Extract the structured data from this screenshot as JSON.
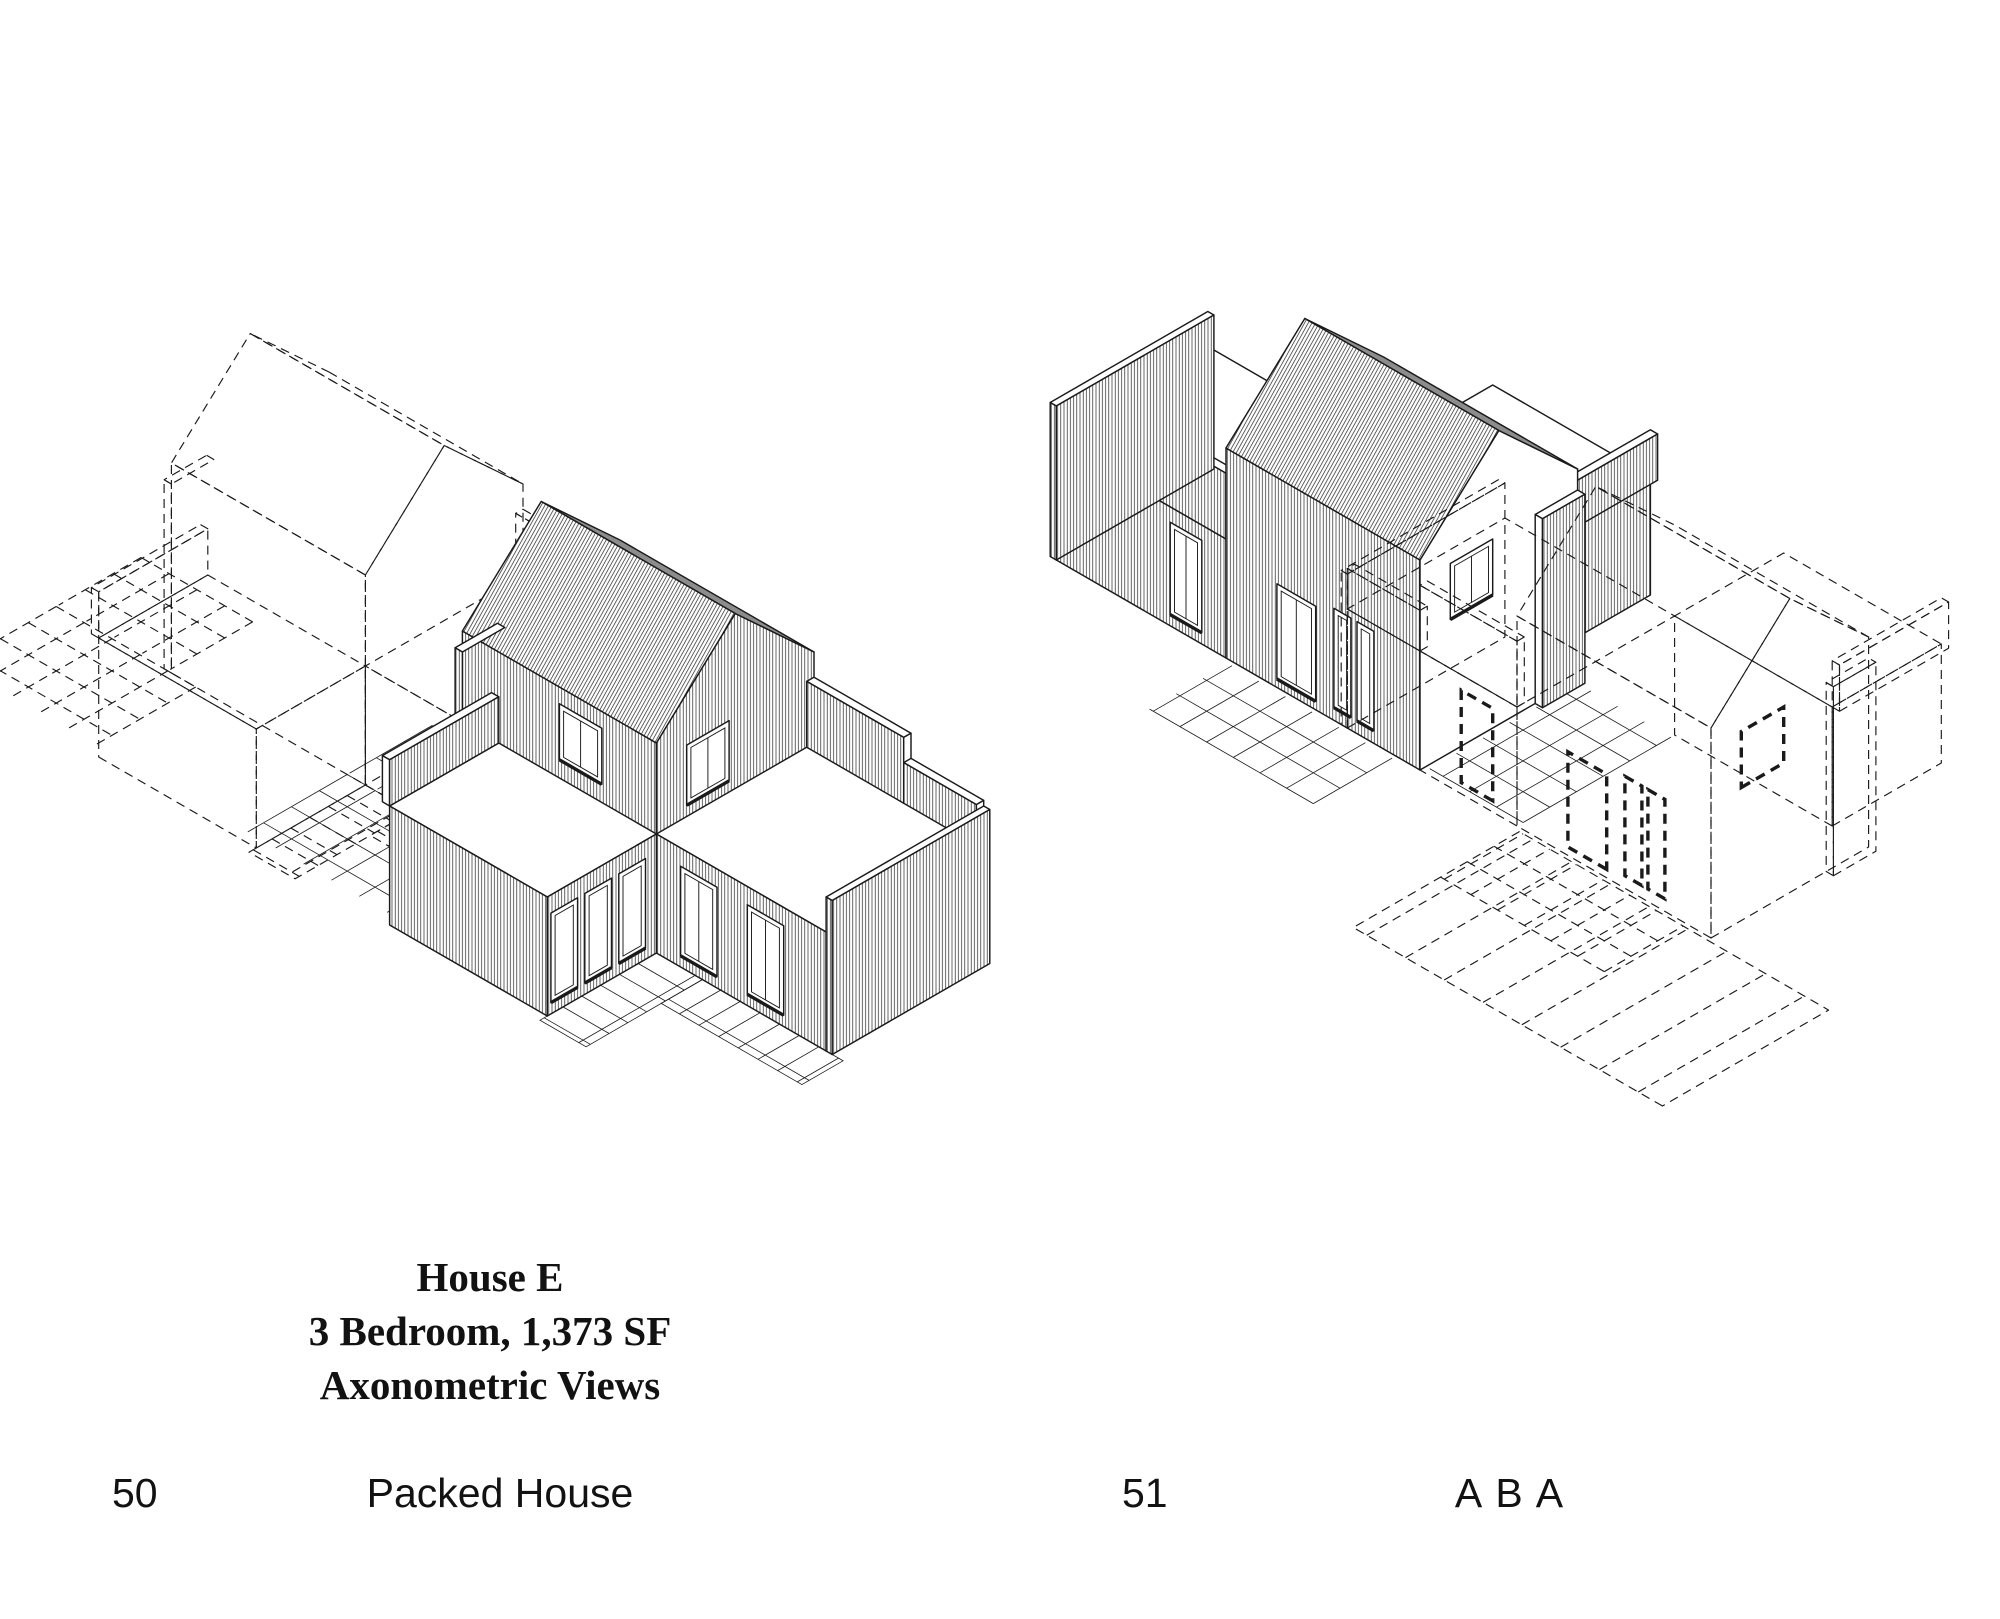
{
  "page": {
    "background": "#ffffff",
    "ink": "#1a1a1a",
    "roof_shade": "#8c8c8c"
  },
  "left_page": {
    "page_number": "50",
    "footer_title": "Packed House",
    "caption_lines": [
      "House E",
      "3 Bedroom, 1,373 SF",
      "Axonometric Views"
    ]
  },
  "right_page": {
    "page_number": "51",
    "footer_title": "A B A"
  }
}
